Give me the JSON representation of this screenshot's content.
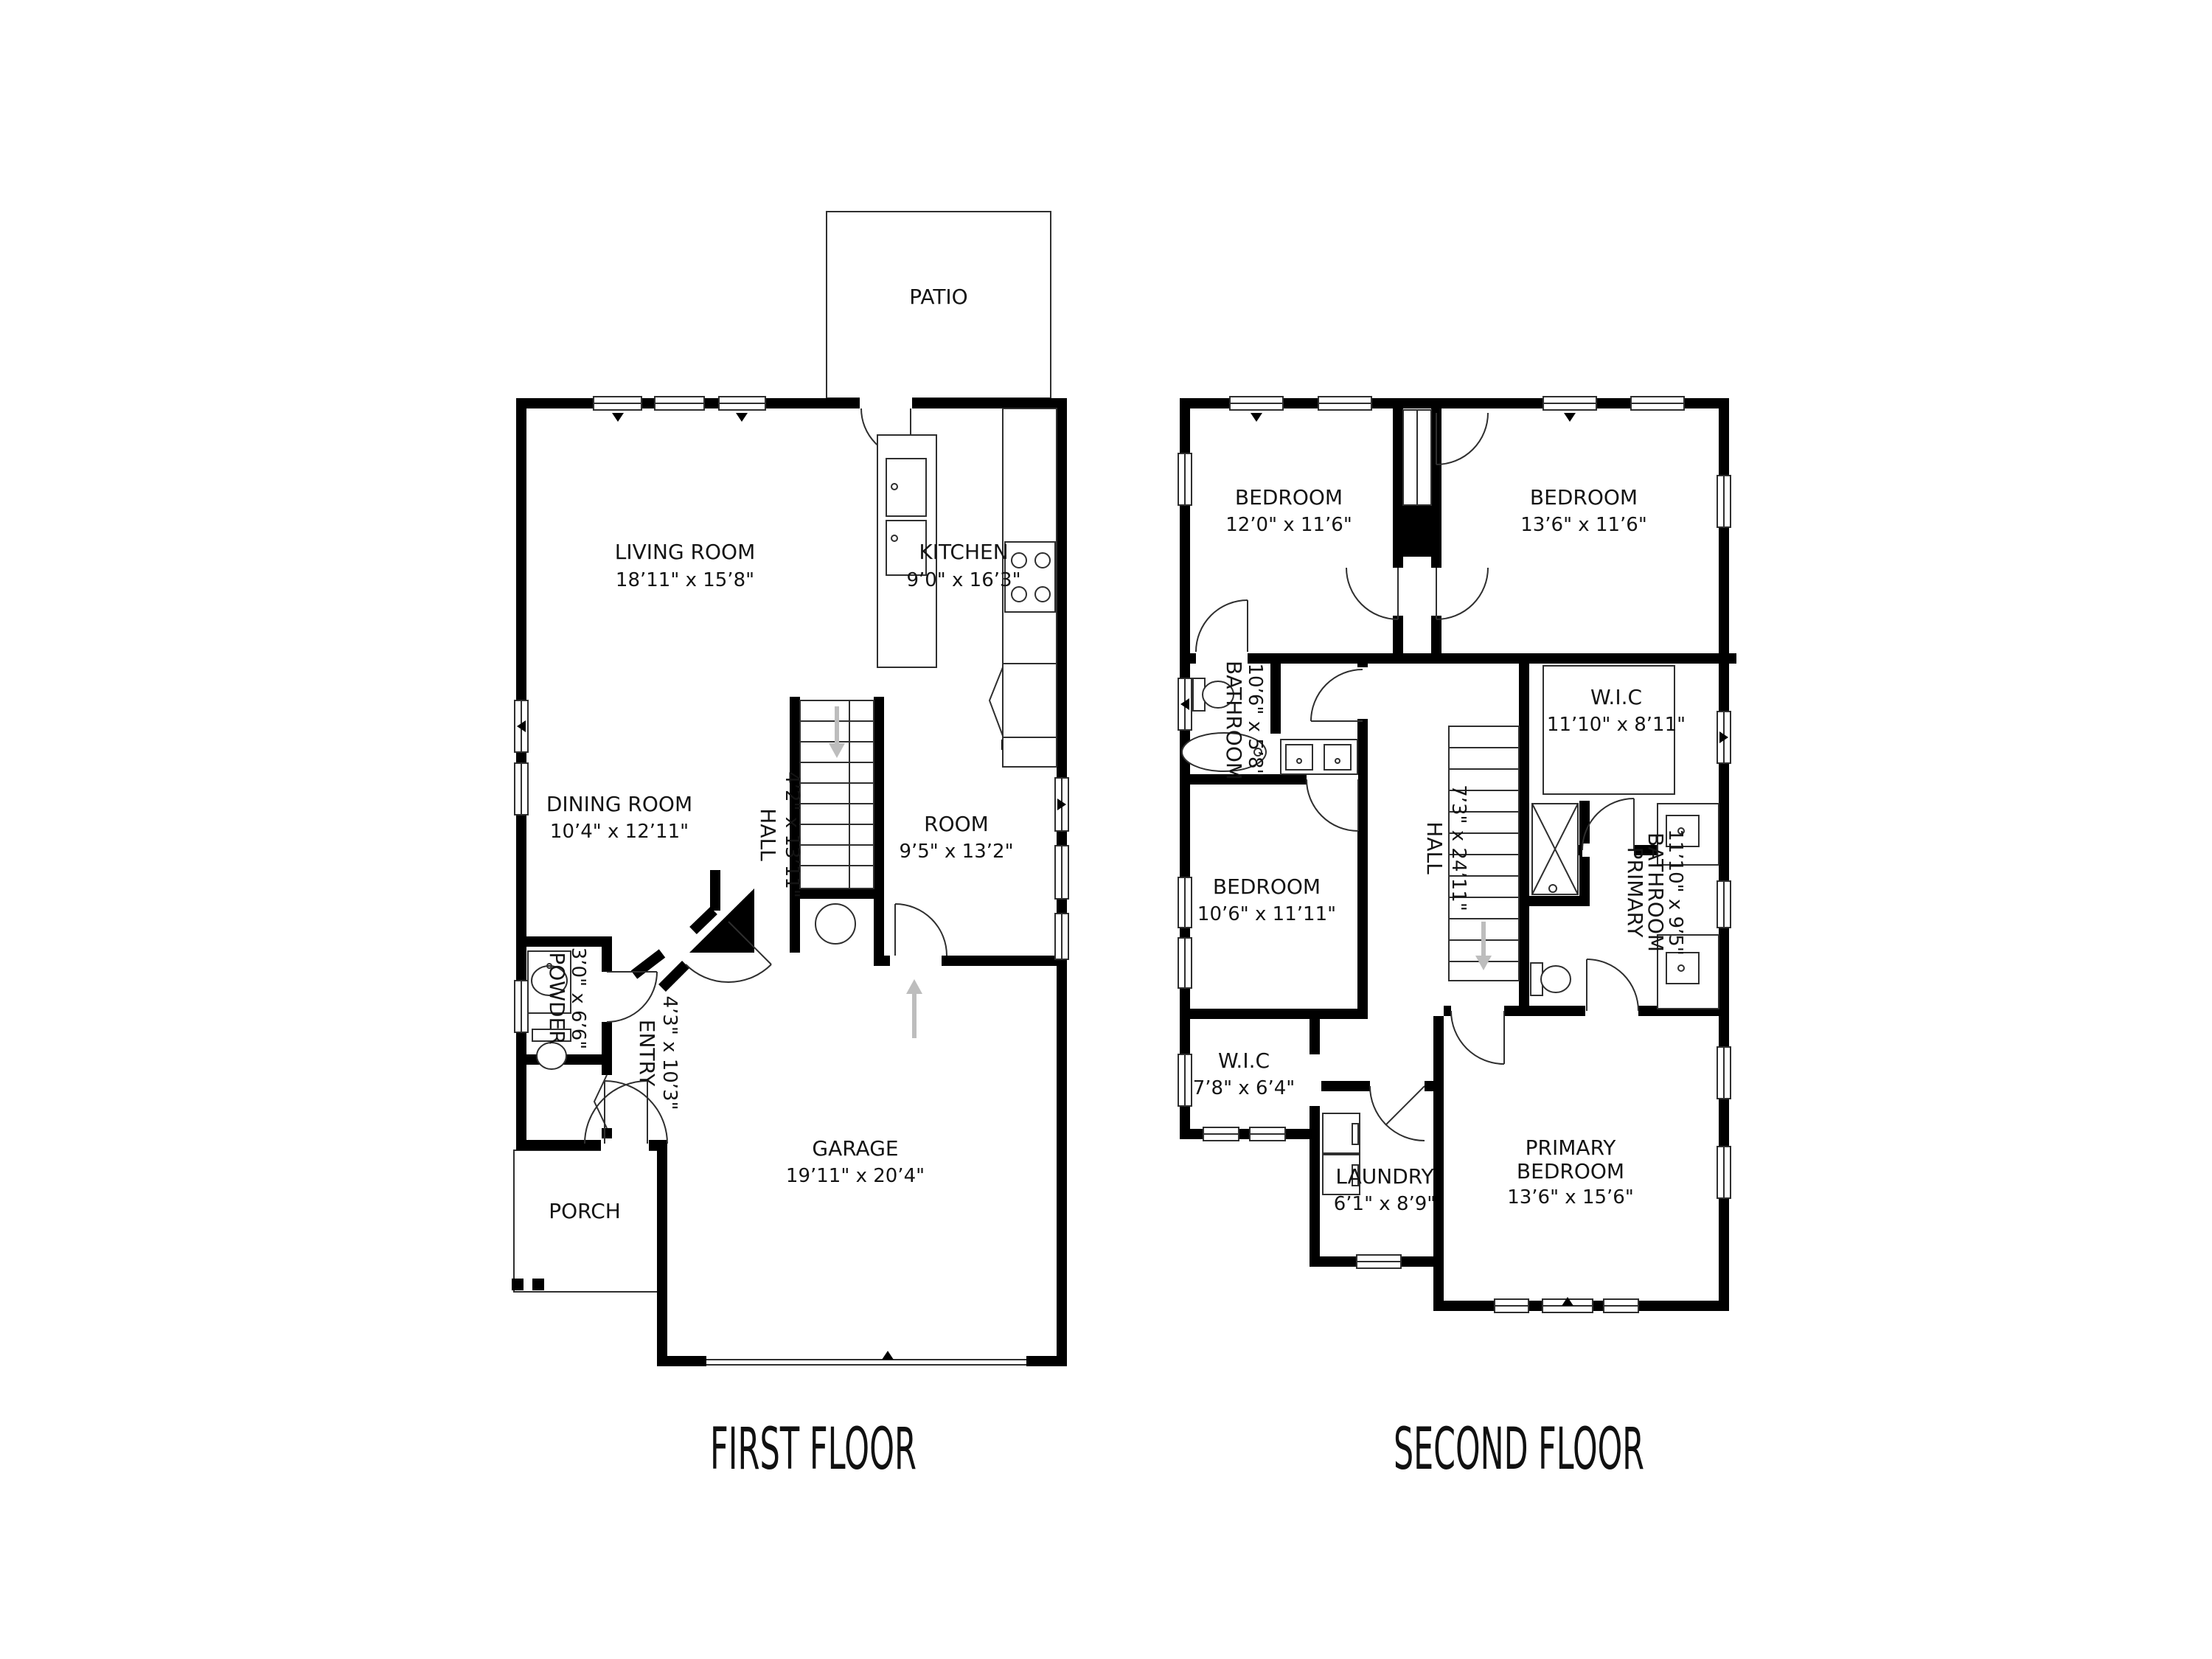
{
  "page": {
    "background": "#ffffff"
  },
  "colors": {
    "wall": "#000000",
    "line": "#2f2f2f",
    "arrow": "#bdbdbd",
    "text": "#141414"
  },
  "floors": [
    {
      "title": "FIRST FLOOR",
      "rooms": [
        {
          "name": "PATIO",
          "dims": ""
        },
        {
          "name": "LIVING ROOM",
          "dims": "18’11\" x 15’8\""
        },
        {
          "name": "KITCHEN",
          "dims": "9’0\" x 16’3\""
        },
        {
          "name": "DINING ROOM",
          "dims": "10’4\" x 12’11\""
        },
        {
          "name": "HALL",
          "dims": "4’2\" x 13’11\""
        },
        {
          "name": "ROOM",
          "dims": "9’5\" x 13’2\""
        },
        {
          "name": "POWDER",
          "dims": "3’0\" x 6’6\""
        },
        {
          "name": "ENTRY",
          "dims": "4’3\" x 10’3\""
        },
        {
          "name": "GARAGE",
          "dims": "19’11\" x 20’4\""
        },
        {
          "name": "PORCH",
          "dims": ""
        }
      ]
    },
    {
      "title": "SECOND FLOOR",
      "rooms": [
        {
          "name": "BEDROOM",
          "dims": "12’0\" x 11’6\""
        },
        {
          "name": "BEDROOM",
          "dims": "13’6\" x 11’6\""
        },
        {
          "name": "BATHROOM",
          "dims": "10’6\" x 5’8\""
        },
        {
          "name": "W.I.C",
          "dims": "11’10\" x 8’11\""
        },
        {
          "name": "HALL",
          "dims": "7’3\" x 24’11\""
        },
        {
          "name": "BEDROOM",
          "dims": "10’6\" x 11’11\""
        },
        {
          "name": "PRIMARY BATHROOM",
          "name_lines": [
            "PRIMARY",
            "BATHROOM"
          ],
          "dims": "11’10\" x 9’5\""
        },
        {
          "name": "W.I.C",
          "dims": "7’8\" x 6’4\""
        },
        {
          "name": "LAUNDRY",
          "dims": "6’1\" x 8’9\""
        },
        {
          "name": "PRIMARY BEDROOM",
          "name_lines": [
            "PRIMARY",
            "BEDROOM"
          ],
          "dims": "13’6\" x 15’6\""
        }
      ]
    }
  ]
}
